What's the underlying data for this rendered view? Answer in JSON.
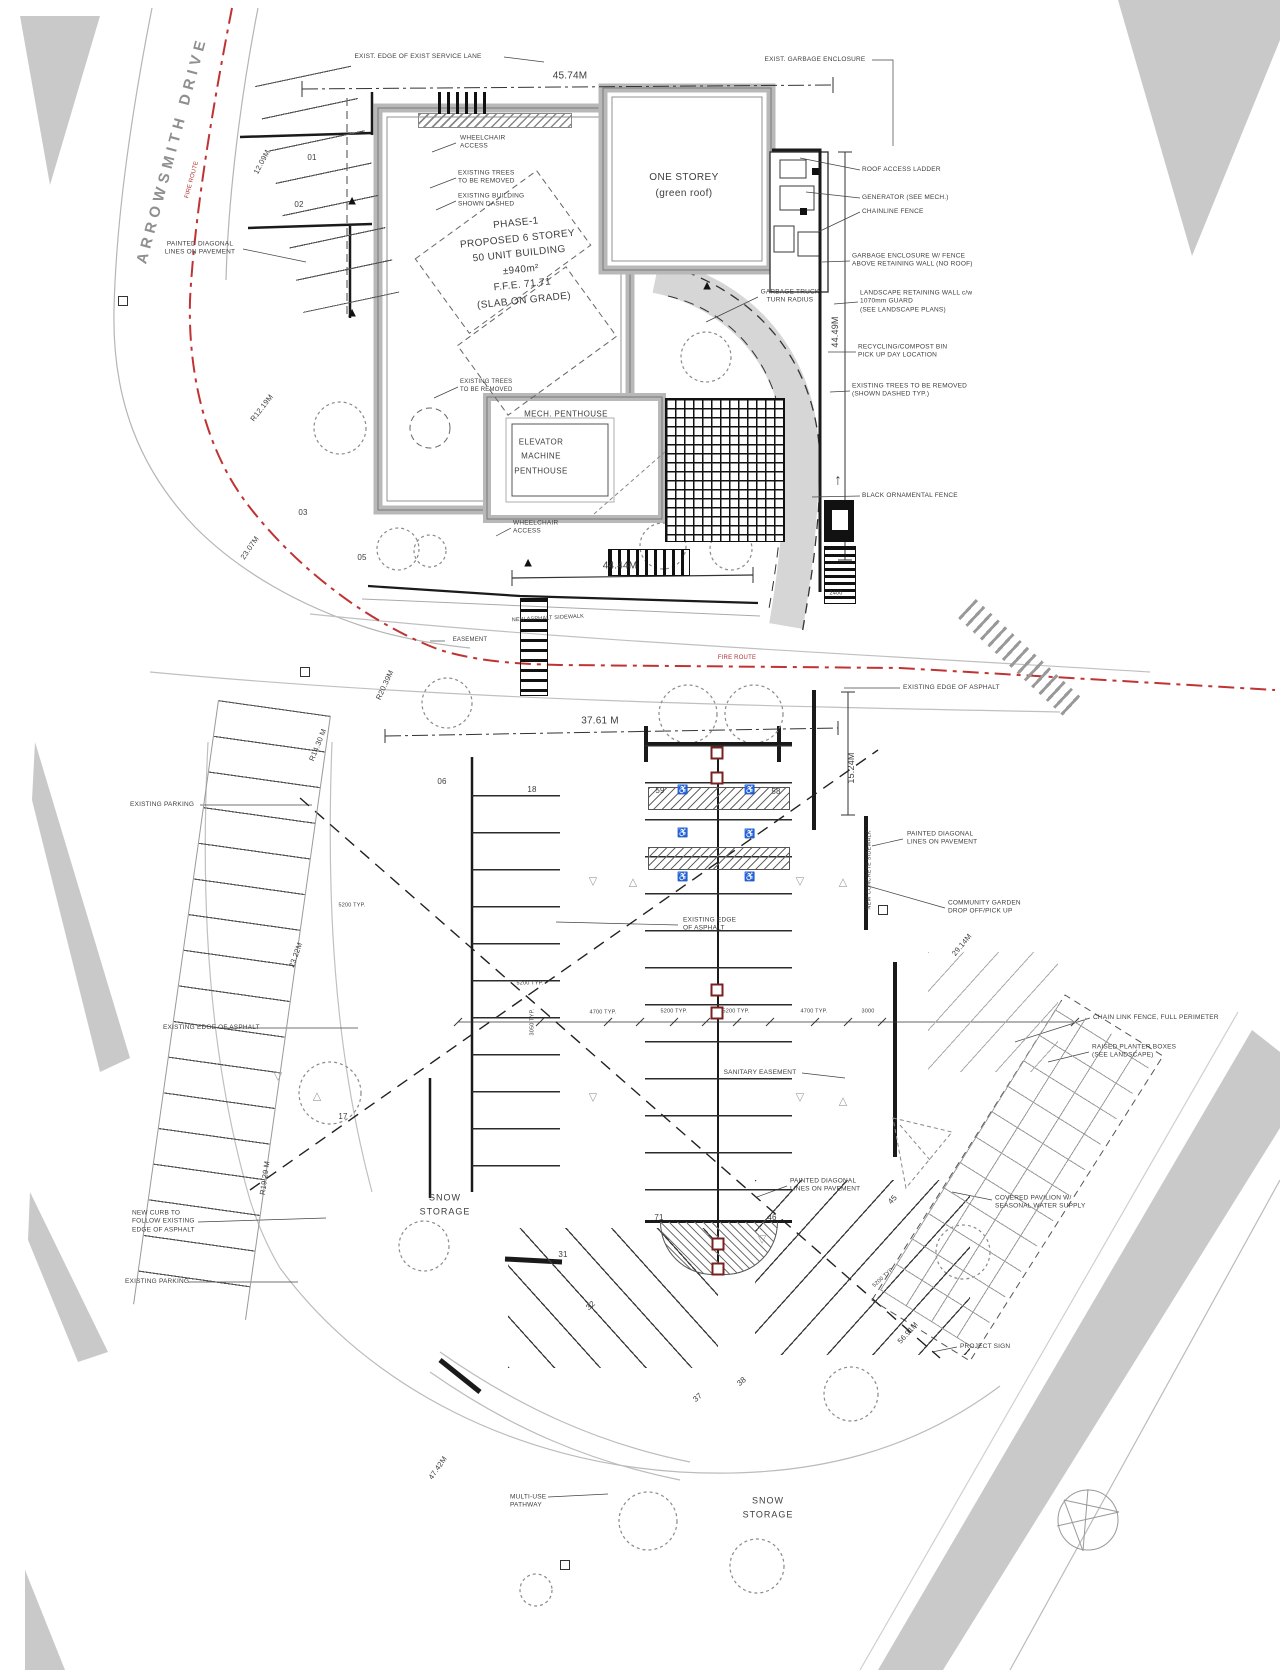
{
  "blocks": {
    "street": "ARROWSMITH DRIVE",
    "phase1": "PHASE-1\nPROPOSED 6 STOREY\n50 UNIT BUILDING\n±940m²\nF.F.E. 71.71\n(SLAB ON GRADE)",
    "one_storey": "ONE STOREY\n(green roof)",
    "mech_penthouse": "MECH. PENTHOUSE",
    "elevator": "ELEVATOR\nMACHINE\nPENTHOUSE",
    "snow_storage_left": "SNOW\nSTORAGE",
    "snow_storage_bottom": "SNOW\nSTORAGE"
  },
  "labels": [
    {
      "n": "exist-service-lane-label",
      "t": "EXIST. EDGE OF EXIST SERVICE LANE",
      "x": 418,
      "y": 57,
      "s": 6.5
    },
    {
      "n": "exist-garbage-enclosure-label",
      "t": "EXIST. GARBAGE ENCLOSURE",
      "x": 815,
      "y": 60,
      "s": 6.5
    },
    {
      "n": "dim-45-74",
      "t": "45.74M",
      "x": 570,
      "y": 76,
      "s": 10
    },
    {
      "n": "wheelchair-access-label-1",
      "t": "WHEELCHAIR\nACCESS",
      "x": 460,
      "y": 143,
      "s": 6.5,
      "a": "l"
    },
    {
      "n": "existing-trees-label-1",
      "t": "EXISTING TREES\nTO BE REMOVED",
      "x": 458,
      "y": 178,
      "s": 6.5,
      "a": "l"
    },
    {
      "n": "existing-building-dashed-label",
      "t": "EXISTING BUILDING\nSHOWN DASHED",
      "x": 458,
      "y": 201,
      "s": 6.5,
      "a": "l"
    },
    {
      "n": "roof-access-ladder-label",
      "t": "ROOF ACCESS LADDER",
      "x": 862,
      "y": 170,
      "s": 6.5,
      "a": "l"
    },
    {
      "n": "generator-label",
      "t": "GENERATOR (SEE MECH.)",
      "x": 862,
      "y": 198,
      "s": 6.5,
      "a": "l"
    },
    {
      "n": "chainlink-fence-label",
      "t": "CHAINLINE FENCE",
      "x": 862,
      "y": 212,
      "s": 6.5,
      "a": "l"
    },
    {
      "n": "painted-diagonal-label-1",
      "t": "PAINTED DIAGONAL\nLINES ON PAVEMENT",
      "x": 200,
      "y": 249,
      "s": 6.5
    },
    {
      "n": "garbage-enclosure-fence-label",
      "t": "GARBAGE ENCLOSURE W/ FENCE\nABOVE RETAINING WALL (NO ROOF)",
      "x": 852,
      "y": 261,
      "s": 6.5,
      "a": "l"
    },
    {
      "n": "garbage-truck-radius-label",
      "t": "GARBAGE TRUCK\nTURN RADIUS",
      "x": 790,
      "y": 297,
      "s": 6.5
    },
    {
      "n": "landscape-retaining-wall-label",
      "t": "LANDSCAPE RETAINING WALL c/w\n1070mm GUARD\n(SEE LANDSCAPE PLANS)",
      "x": 860,
      "y": 302,
      "s": 6.5,
      "a": "l"
    },
    {
      "n": "recycling-compost-label",
      "t": "RECYCLING/COMPOST BIN\nPICK UP DAY LOCATION",
      "x": 858,
      "y": 352,
      "s": 6.5,
      "a": "l"
    },
    {
      "n": "existing-trees-removed-label-2",
      "t": "EXISTING TREES TO BE REMOVED\n(SHOWN DASHED TYP.)",
      "x": 852,
      "y": 391,
      "s": 6.5,
      "a": "l"
    },
    {
      "n": "dim-44-49",
      "t": "44.49M",
      "x": 836,
      "y": 332,
      "r": -90,
      "s": 9
    },
    {
      "n": "existing-trees-label-3",
      "t": "EXISTING TREES\nTO BE REMOVED",
      "x": 460,
      "y": 387,
      "s": 6,
      "a": "l"
    },
    {
      "n": "black-ornamental-fence-label",
      "t": "BLACK ORNAMENTAL FENCE",
      "x": 862,
      "y": 496,
      "s": 6.5,
      "a": "l"
    },
    {
      "n": "wheelchair-access-label-2",
      "t": "WHEELCHAIR\nACCESS",
      "x": 513,
      "y": 528,
      "s": 6.5,
      "a": "l"
    },
    {
      "n": "dim-44-44",
      "t": "44.44M",
      "x": 620,
      "y": 566,
      "s": 10
    },
    {
      "n": "dim-12-09",
      "t": "12.09M",
      "x": 262,
      "y": 162,
      "r": -62,
      "s": 7.5
    },
    {
      "n": "radius-12-19",
      "t": "R12.19M",
      "x": 262,
      "y": 408,
      "r": -52,
      "s": 7.5
    },
    {
      "n": "space-01",
      "t": "01",
      "x": 312,
      "y": 158,
      "s": 8
    },
    {
      "n": "space-02",
      "t": "02",
      "x": 299,
      "y": 205,
      "s": 8
    },
    {
      "n": "space-03",
      "t": "03",
      "x": 303,
      "y": 513,
      "s": 8
    },
    {
      "n": "space-05",
      "t": "05",
      "x": 362,
      "y": 558,
      "s": 8
    },
    {
      "n": "dim-23-07",
      "t": "23.07M",
      "x": 250,
      "y": 548,
      "r": -55,
      "s": 7.5
    },
    {
      "n": "fire-route-text-1",
      "t": "FIRE ROUTE",
      "x": 193,
      "y": 180,
      "r": -75,
      "s": 6,
      "c": "red"
    },
    {
      "n": "fire-route-text-2",
      "t": "FIRE ROUTE",
      "x": 737,
      "y": 659,
      "s": 6,
      "c": "red"
    },
    {
      "n": "easement-label",
      "t": "EASEMENT",
      "x": 470,
      "y": 641,
      "s": 6
    },
    {
      "n": "new-asphalt-sidewalk-label",
      "t": "NEW ASPHALT SIDEWALK",
      "x": 548,
      "y": 619,
      "r": -3,
      "s": 5.5
    },
    {
      "n": "dim-37-61",
      "t": "37.61 M",
      "x": 600,
      "y": 721,
      "s": 10
    },
    {
      "n": "existing-edge-asphalt-label-r",
      "t": "EXISTING EDGE OF ASPHALT",
      "x": 903,
      "y": 688,
      "s": 6.5,
      "a": "l"
    },
    {
      "n": "radius-20-39",
      "t": "R20.39M",
      "x": 385,
      "y": 685,
      "r": -65,
      "s": 7.5
    },
    {
      "n": "radius-14-30",
      "t": "R14.30 M",
      "x": 318,
      "y": 745,
      "r": -68,
      "s": 7.5
    },
    {
      "n": "space-06",
      "t": "06",
      "x": 442,
      "y": 782,
      "s": 8
    },
    {
      "n": "space-18",
      "t": "18",
      "x": 532,
      "y": 790,
      "s": 8
    },
    {
      "n": "space-59",
      "t": "59",
      "x": 660,
      "y": 791,
      "s": 8
    },
    {
      "n": "space-58",
      "t": "58",
      "x": 776,
      "y": 792,
      "s": 8
    },
    {
      "n": "dim-15-24",
      "t": "15.24M",
      "x": 852,
      "y": 768,
      "r": -90,
      "s": 9
    },
    {
      "n": "painted-diagonal-label-2",
      "t": "PAINTED DIAGONAL\nLINES ON PAVEMENT",
      "x": 907,
      "y": 839,
      "s": 6.5,
      "a": "l"
    },
    {
      "n": "community-garden-label",
      "t": "COMMUNITY GARDEN\nDROP OFF/PICK UP",
      "x": 948,
      "y": 908,
      "s": 6.5,
      "a": "l"
    },
    {
      "n": "new-concrete-sidewalk-label",
      "t": "NEW CONCRETE SIDEWALK",
      "x": 870,
      "y": 870,
      "r": -90,
      "s": 5.5
    },
    {
      "n": "existing-edge-asphalt-label-c",
      "t": "EXISTING EDGE\nOF ASPHALT",
      "x": 683,
      "y": 925,
      "s": 6.5,
      "a": "l"
    },
    {
      "n": "dim-23-22",
      "t": "23.22M",
      "x": 296,
      "y": 955,
      "r": -70,
      "s": 7.5
    },
    {
      "n": "existing-parking-label-1",
      "t": "EXISTING PARKING",
      "x": 130,
      "y": 805,
      "s": 6.5,
      "a": "l"
    },
    {
      "n": "typ-5200-left",
      "t": "5200 TYP.",
      "x": 352,
      "y": 906,
      "s": 5.5
    },
    {
      "n": "typ-3050",
      "t": "3050 TYP.",
      "x": 533,
      "y": 1022,
      "r": -90,
      "s": 5.5
    },
    {
      "n": "typ-5200-mid",
      "t": "5200 TYP.",
      "x": 530,
      "y": 984,
      "s": 5.5
    },
    {
      "n": "typ-4700-a",
      "t": "4700 TYP.",
      "x": 603,
      "y": 1013,
      "s": 5.5
    },
    {
      "n": "typ-5200-b",
      "t": "5200 TYP.",
      "x": 674,
      "y": 1012,
      "s": 5.5
    },
    {
      "n": "typ-5200-c",
      "t": "5200 TYP.",
      "x": 736,
      "y": 1012,
      "s": 5.5
    },
    {
      "n": "typ-4700-d",
      "t": "4700 TYP.",
      "x": 814,
      "y": 1012,
      "s": 5.5
    },
    {
      "n": "dim-3000",
      "t": "3000",
      "x": 868,
      "y": 1012,
      "s": 5.5
    },
    {
      "n": "sanitary-easement-label",
      "t": "SANITARY EASEMENT",
      "x": 760,
      "y": 1073,
      "s": 6.5
    },
    {
      "n": "chain-link-perimeter-label",
      "t": "CHAIN LINK FENCE, FULL PERIMETER",
      "x": 1093,
      "y": 1018,
      "s": 6.5,
      "a": "l"
    },
    {
      "n": "raised-planter-label",
      "t": "RAISED PLANTER BOXES\n(SEE LANDSCAPE)",
      "x": 1092,
      "y": 1052,
      "s": 6.5,
      "a": "l"
    },
    {
      "n": "dim-29-14",
      "t": "29.14M",
      "x": 962,
      "y": 945,
      "r": -50,
      "s": 7.5
    },
    {
      "n": "existing-edge-asphalt-label-l",
      "t": "EXISTING EDGE OF ASPHALT",
      "x": 163,
      "y": 1028,
      "s": 6.5,
      "a": "l"
    },
    {
      "n": "space-17",
      "t": "17",
      "x": 343,
      "y": 1117,
      "s": 8
    },
    {
      "n": "radius-19-29",
      "t": "R19.29 M",
      "x": 265,
      "y": 1178,
      "r": -82,
      "s": 7.5
    },
    {
      "n": "new-curb-label",
      "t": "NEW CURB TO\nFOLLOW EXISTING\nEDGE OF ASPHALT",
      "x": 132,
      "y": 1222,
      "s": 6.5,
      "a": "l"
    },
    {
      "n": "space-71",
      "t": "71",
      "x": 659,
      "y": 1218,
      "s": 8
    },
    {
      "n": "space-46",
      "t": "46",
      "x": 772,
      "y": 1218,
      "s": 8
    },
    {
      "n": "space-45",
      "t": "45",
      "x": 893,
      "y": 1200,
      "r": -48,
      "s": 8
    },
    {
      "n": "painted-diagonal-label-3",
      "t": "PAINTED DIAGONAL\nLINES ON PAVEMENT",
      "x": 790,
      "y": 1186,
      "s": 6.5,
      "a": "l"
    },
    {
      "n": "space-31",
      "t": "31",
      "x": 563,
      "y": 1255,
      "s": 8
    },
    {
      "n": "space-32",
      "t": "32",
      "x": 591,
      "y": 1306,
      "r": -42,
      "s": 8
    },
    {
      "n": "existing-parking-label-2",
      "t": "EXISTING PARKING",
      "x": 125,
      "y": 1282,
      "s": 6.5,
      "a": "l"
    },
    {
      "n": "typ-5200-f",
      "t": "5200 TYP.",
      "x": 884,
      "y": 1278,
      "r": -42,
      "s": 5.5
    },
    {
      "n": "covered-pavilion-label",
      "t": "COVERED PAVILION W/\nSEASONAL WATER SUPPLY",
      "x": 995,
      "y": 1203,
      "s": 6.5,
      "a": "l"
    },
    {
      "n": "space-37",
      "t": "37",
      "x": 698,
      "y": 1398,
      "r": -40,
      "s": 8
    },
    {
      "n": "space-38",
      "t": "38",
      "x": 742,
      "y": 1382,
      "r": -40,
      "s": 8
    },
    {
      "n": "project-sign-label",
      "t": "PROJECT SIGN",
      "x": 960,
      "y": 1347,
      "s": 6.5,
      "a": "l"
    },
    {
      "n": "dim-56-91",
      "t": "56.91M",
      "x": 908,
      "y": 1333,
      "r": -48,
      "s": 7.5
    },
    {
      "n": "multiuse-pathway-label",
      "t": "MULTI-USE\nPATHWAY",
      "x": 510,
      "y": 1502,
      "s": 6.5,
      "a": "l"
    },
    {
      "n": "dim-47-42",
      "t": "47.42M",
      "x": 438,
      "y": 1468,
      "r": -55,
      "s": 7.5
    },
    {
      "n": "dim-2400",
      "t": "2400",
      "x": 836,
      "y": 594,
      "s": 5.5
    },
    {
      "n": "stair-up-arrow",
      "t": "↑",
      "x": 838,
      "y": 480,
      "s": 15
    }
  ],
  "markers": {
    "bollards": [
      [
        717,
        753
      ],
      [
        717,
        778
      ],
      [
        717,
        990
      ],
      [
        717,
        1013
      ],
      [
        718,
        1244
      ],
      [
        718,
        1269
      ]
    ],
    "catch_basins": [
      [
        123,
        301
      ],
      [
        305,
        672
      ],
      [
        565,
        1565
      ],
      [
        883,
        910
      ]
    ],
    "entry_triangles": [
      [
        352,
        200
      ],
      [
        352,
        312
      ],
      [
        528,
        562
      ],
      [
        707,
        285
      ]
    ],
    "pavement_arrows": [
      {
        "x": 593,
        "y": 882,
        "g": "▽"
      },
      {
        "x": 633,
        "y": 883,
        "g": "△"
      },
      {
        "x": 800,
        "y": 882,
        "g": "▽"
      },
      {
        "x": 843,
        "y": 883,
        "g": "△"
      },
      {
        "x": 593,
        "y": 1098,
        "g": "▽"
      },
      {
        "x": 800,
        "y": 1098,
        "g": "▽"
      },
      {
        "x": 843,
        "y": 1102,
        "g": "△"
      },
      {
        "x": 278,
        "y": 1077,
        "g": "▽"
      },
      {
        "x": 317,
        "y": 1097,
        "g": "△"
      },
      {
        "x": 762,
        "y": 1240,
        "g": "▽"
      }
    ],
    "accessible_stalls": [
      [
        683,
        790
      ],
      [
        750,
        790
      ],
      [
        683,
        833
      ],
      [
        750,
        834
      ],
      [
        683,
        877
      ],
      [
        750,
        877
      ]
    ]
  },
  "colors": {
    "fire_route": "#c03333",
    "wall_grey": "#b8b8b8",
    "area_grey": "#c9c9c9",
    "line_dark": "#3d3d3d",
    "bollard_red": "#7b2020"
  }
}
